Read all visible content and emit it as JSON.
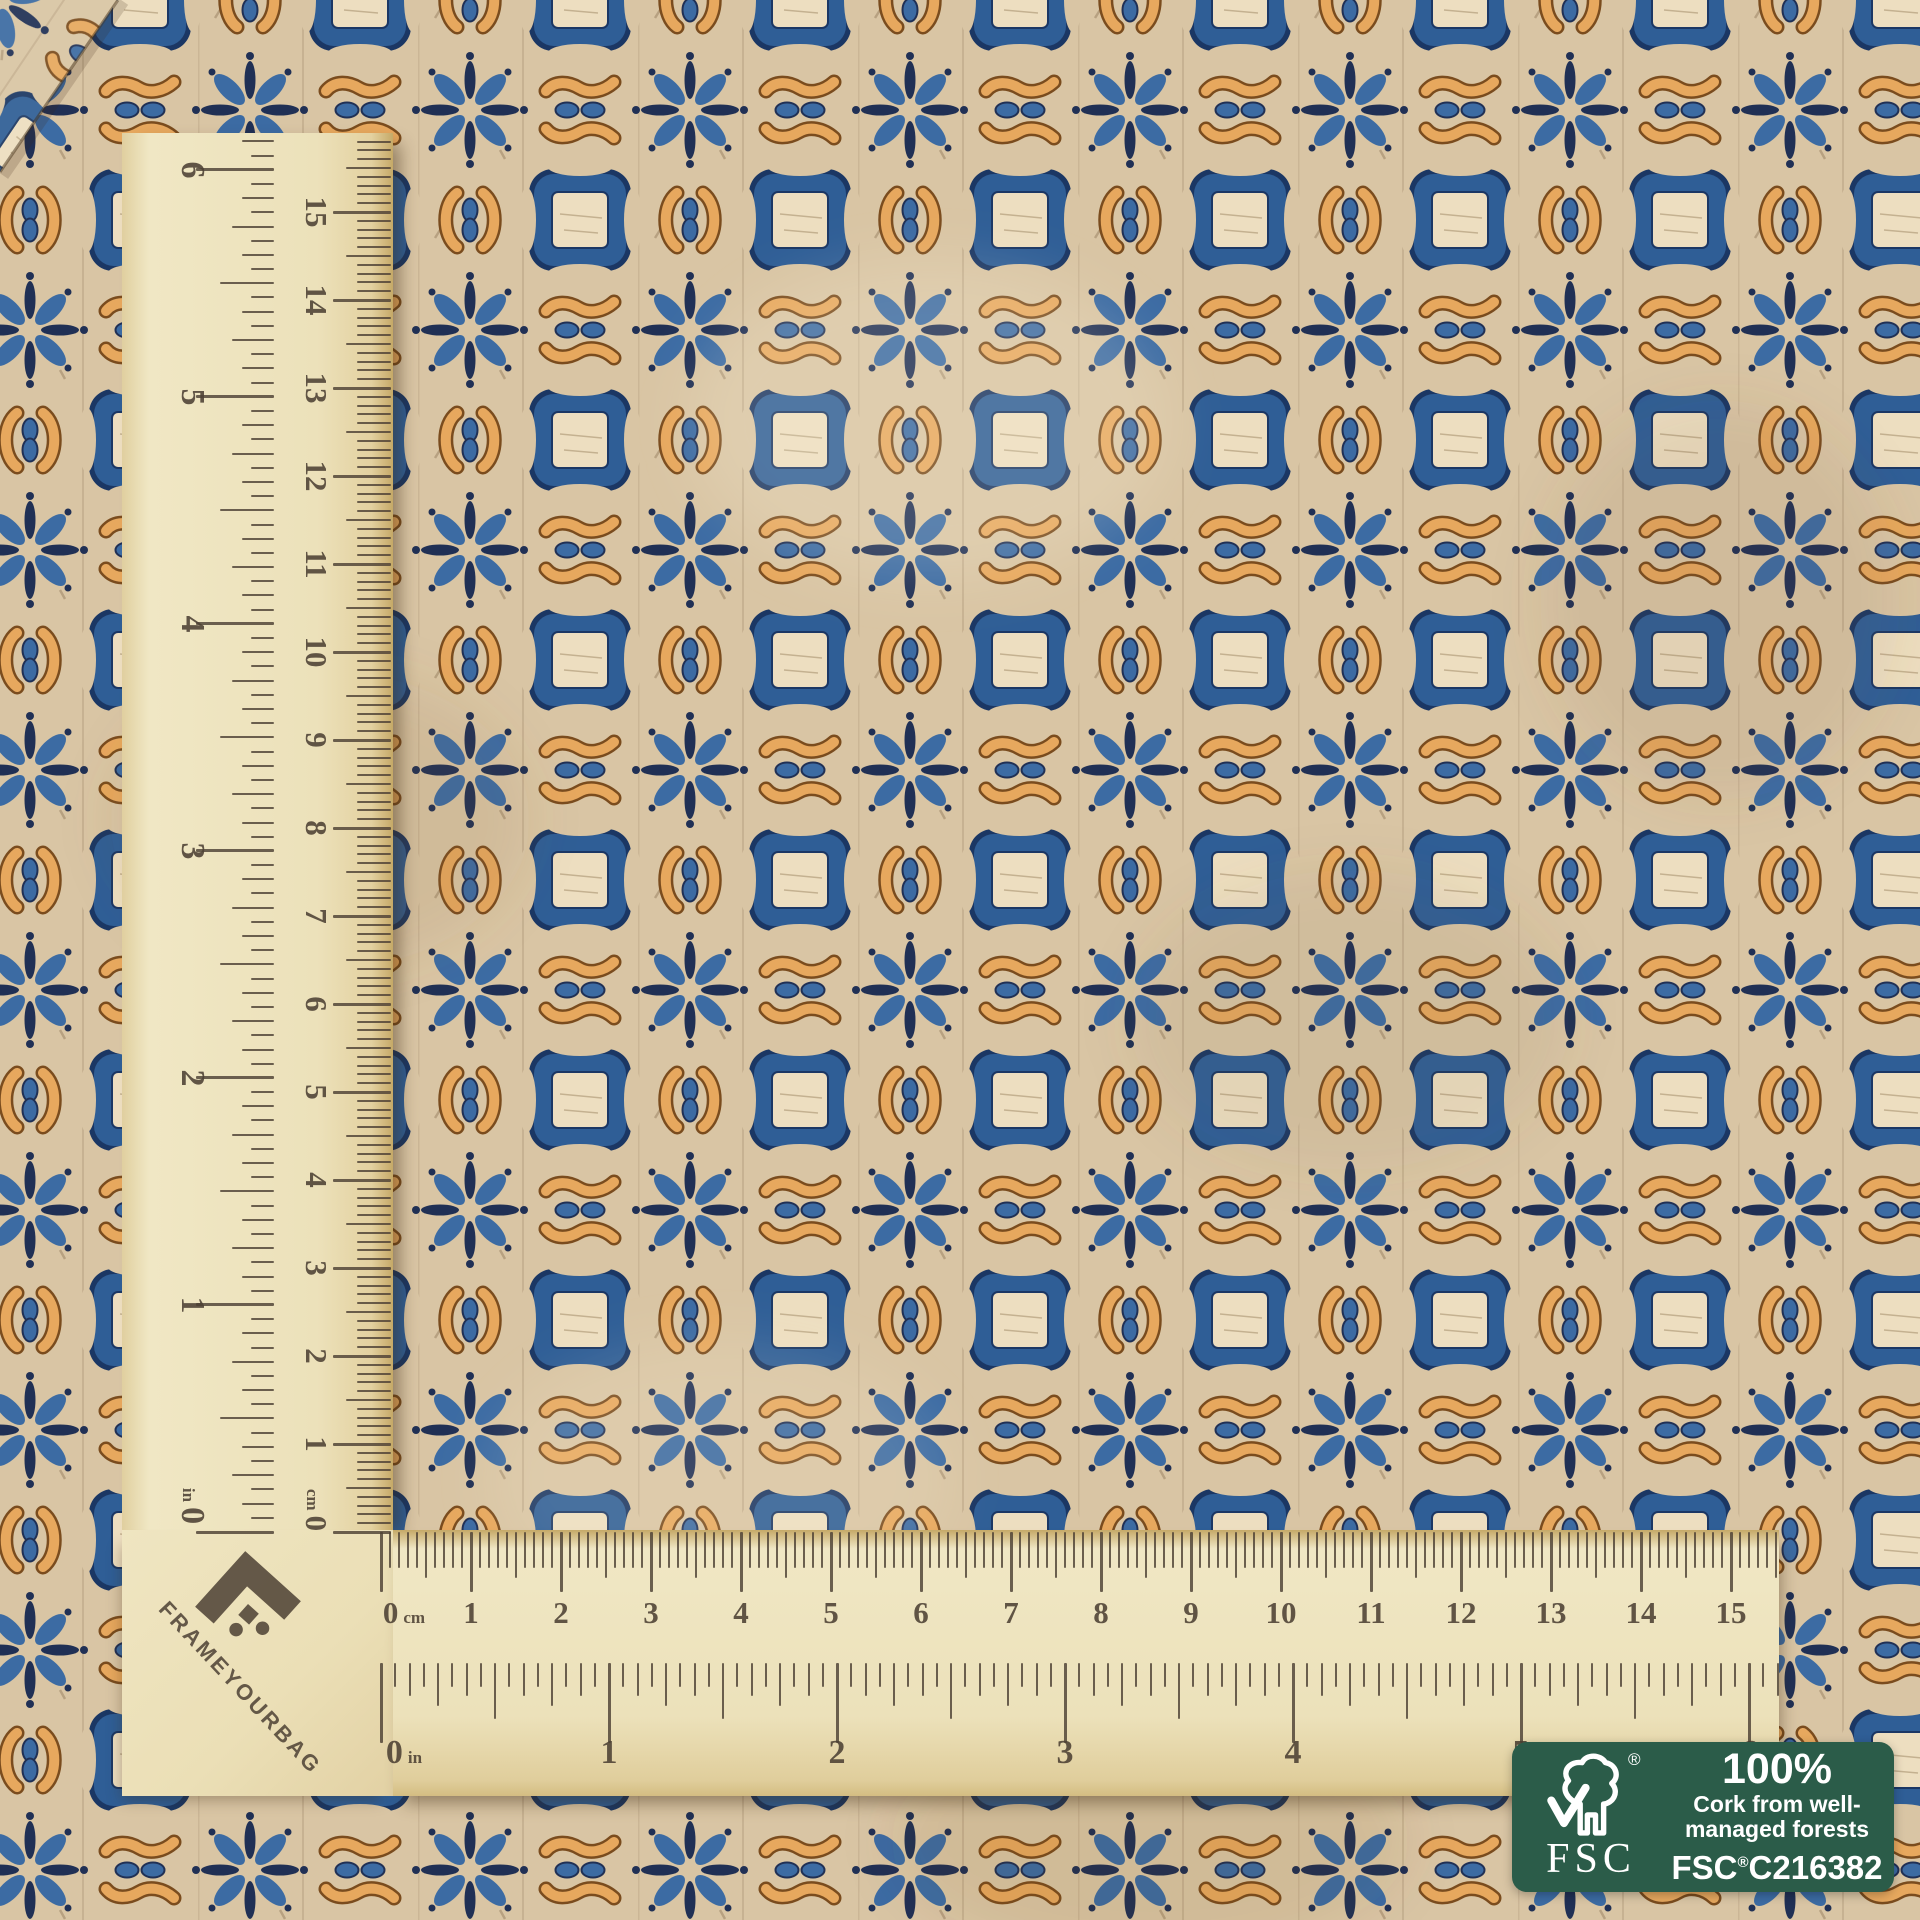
{
  "ruler": {
    "brand": "FRAMEYOURBAG",
    "zero": "0",
    "cm_unit": "cm",
    "inch_unit": "in",
    "cm_numbers": [
      "1",
      "2",
      "3",
      "4",
      "5",
      "6",
      "7",
      "8",
      "9",
      "10",
      "11",
      "12",
      "13",
      "14",
      "15"
    ],
    "inch_numbers": [
      "1",
      "2",
      "3",
      "4",
      "5",
      "6"
    ]
  },
  "badge": {
    "percent": "100%",
    "line1": "Cork from well-",
    "line2": "managed forests",
    "brand": "FSC",
    "reg": "®",
    "code_prefix": "FSC",
    "code_reg": "®",
    "code_number": "C216382",
    "green": "#2b5c49"
  },
  "fabric": {
    "colors": {
      "base": "#d9c5a4",
      "square_frame": "#2f5e96",
      "square_frame_dark": "#1b3764",
      "square_center": "#eddec0",
      "flower_blue": "#3c6ba3",
      "navy": "#203055",
      "orange": "#e7a85e",
      "orange_outline": "#7a4c1e"
    }
  },
  "wood": {
    "color": "#ece1ba",
    "ink": "#4d4134"
  }
}
